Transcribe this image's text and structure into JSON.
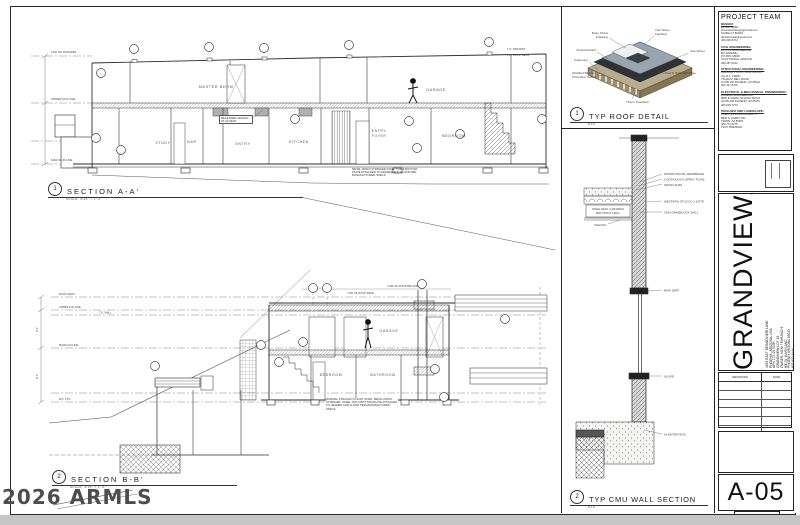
{
  "watermark": "2026 ARMLS",
  "sheet": {
    "number": "A-05",
    "discipline": "SECTIONS",
    "revisions_label": "REVISIONS",
    "date_label": "DATE"
  },
  "project_team": {
    "heading": "PROJECT TEAM",
    "design_title": "DESIGN:",
    "design": [
      "EHSAN AMIRI",
      "ehsanamiridesign@icloud.com",
      "DANIELA TIRADO",
      "daniela.tirado@gmail.com",
      "480.206.8472"
    ],
    "civil_title": "CIVIL ENGINEERING:",
    "civil": [
      "BA CIVIL ENGINEERING",
      "BO ARDEBILI",
      "P.O.BOX 28016",
      "SCOTTSDALE, ARIZONA",
      "480.387.6442"
    ],
    "structural_title": "STRUCTURAL ENGINEERING:",
    "structural": [
      "ARIZONA STRUCTURAL GROUP",
      "JULIA L. KIZER",
      "736 EAST BELL ROAD,",
      "SUITE 100 PHOENIX, AZ 85022",
      "602.347.8700"
    ],
    "electrical_title": "ELECTRICAL & MECHANICAL ENGINEERING:",
    "electrical": [
      "ARDEBILI ENGINEERING",
      "8930 E INDIAN SCHOOL ROAD,",
      "SUITE 200 PHOENIX, AZ 85251",
      "480.628.7070"
    ],
    "landscape_title": "POOL/SPA AND LANDSCAPE:",
    "landscape": [
      "CREATIVE ENVIRONMENTS",
      "8800 S. HARDY DR.",
      "TEMPE, AZ 85284",
      "480.773.6275",
      "TROY BRENNAN"
    ]
  },
  "title_block": {
    "project_name": "GRANDVIEW/",
    "address": [
      "4639 EAST GRANDVIEW LANE",
      "PHOENIX, ARIZONA, USA",
      "APN 172-49-033F",
      "GRANDVIEW LOT 45"
    ],
    "owner": [
      "OWNER: MANI TEHRANCHI",
      "800 W. MARYLAND",
      "PHOENIX ARIZONA 85013",
      "602.820.4944"
    ]
  },
  "section_a": {
    "num": "1",
    "title": "SECTION A-A'",
    "scale": "SCALE: 3/16\" = 1'-0\"",
    "rooms": {
      "master": "MASTER BDRM",
      "garage": "GARAGE",
      "study": "STUDY",
      "bar": "BAR",
      "entry": "ENTRY",
      "kitchen": "KITCHEN",
      "foyer1": "ENTRY",
      "foyer2": "FOYER",
      "bedroom": "BEDROOM"
    },
    "labels": {
      "parapet": "TOP OF PARAPET",
      "upper": "UPPER FLR LINE",
      "main": "MAIN FLR LINE",
      "parapet_right": "T.O. PARAPET",
      "roof_right": "T.O. ROOF DECK",
      "accent_note": "RECESSED CEILING AT ACCENT",
      "stair_note": "METAL MONO STRINGER STAIR, TOP & BOTTOM PLATE ATTACHED TO HEADER AND FLOOR PER MANUFACTURER SPECS."
    }
  },
  "section_b": {
    "num": "2",
    "title": "SECTION B-B'",
    "scale": "SCALE: 3/16\" = 1'-0\"",
    "rooms": {
      "garage": "GARAGE",
      "bedroom": "BEDROOM",
      "bathroom": "BATHROOM"
    },
    "labels": {
      "roof_beyond": "LINE OF ROOF BEYOND",
      "top_deck": "TOP OF ROOF DECK",
      "roof": "ROOF DECK",
      "upper": "UPPER FLR LINE",
      "tow": "T.O. WALL",
      "main": "MAIN FLR LINE",
      "bof": "B.O. FTG",
      "dim_upper": "9'-1\"",
      "dim_lower": "8'-1\"",
      "stair_note": "NORMAL STRAIGHT FLIGHT STAIR, METAL MONO STRINGER, STEEL TOP & BOTTOM PLATE ATTACHED TO HEADER AND FLOOR PER MANUFACTURER SPECS."
    }
  },
  "roof_detail": {
    "num": "1",
    "title": "TYP ROOF DETAIL",
    "scale": "NTS",
    "labels": {
      "base_flash_1": "Base Sheet",
      "base_flash_2": "Flashing",
      "cap_flash_1": "Cap Sheet",
      "cap_flash_2": "Flashing",
      "cap_sheet": "Cap Sheet",
      "protectoboard": "Protectoboard",
      "fasteners": "Fasteners",
      "mbp_1": "Modified Bitumen",
      "mbp_2": "Protection (MBP)",
      "base": "Peel N Stick 180 Base",
      "insulation": "Therm Insulation"
    }
  },
  "cmu_detail": {
    "num": "2",
    "title": "TYP CMU WALL SECTION",
    "scale": "NTS",
    "labels": {
      "wpm": "WATER PROOF MEMBRANE",
      "foam": "CONTINUOUS SPRAY FOAM",
      "shim": "WOOD SHIM",
      "stucco": "WESTERN STUCCO 1 KOTE",
      "cmu": "CMU OMNIBLOCK WALL",
      "deck_1": "STEEL DECK & FRAMING",
      "deck_2": "PER STRUCT ENG.",
      "ceiling": "CEILING",
      "rain": "RAIN DRIP",
      "slope": "SLOPE",
      "slab": "SLAB PER ENG."
    }
  }
}
